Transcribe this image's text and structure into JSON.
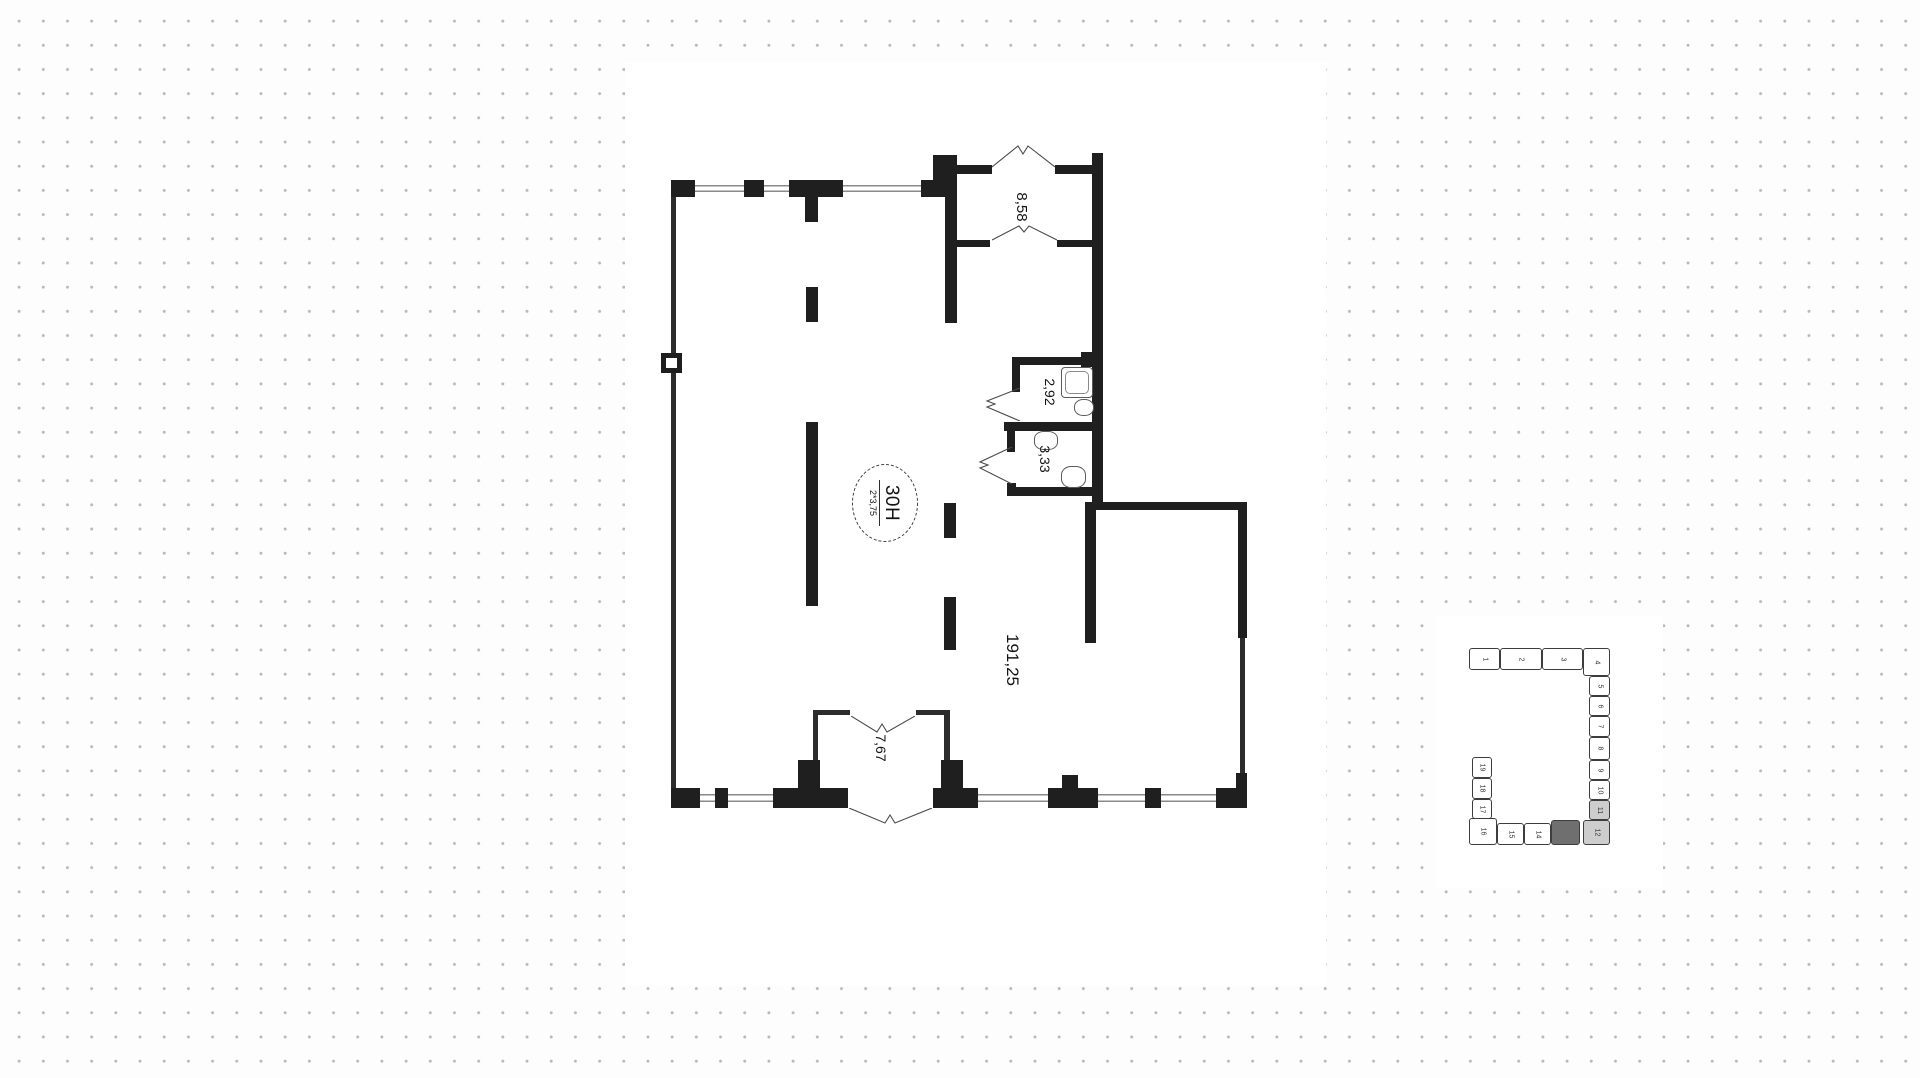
{
  "page": {
    "background_dot_color": "#b9b9b9",
    "wall_color": "#1f1f1f",
    "highlight_current_color": "#6f6f6f",
    "highlight_adjacent_color": "#cdcdcd"
  },
  "floor_plan": {
    "unit_badge": {
      "number": "30H",
      "note": "2*3,75"
    },
    "areas": {
      "top_room": "8,58",
      "wc_small": "2,92",
      "wc_large": "3,33",
      "main_room": "191,25",
      "vestibule": "7,67"
    }
  },
  "minimap": {
    "blocks": [
      {
        "label": "1"
      },
      {
        "label": "2"
      },
      {
        "label": "3"
      },
      {
        "label": "4"
      },
      {
        "label": "5"
      },
      {
        "label": "6"
      },
      {
        "label": "7"
      },
      {
        "label": "8"
      },
      {
        "label": "9"
      },
      {
        "label": "10"
      },
      {
        "label": "11"
      },
      {
        "label": "12"
      },
      {
        "label": ""
      },
      {
        "label": "14"
      },
      {
        "label": "15"
      },
      {
        "label": "16"
      },
      {
        "label": "17"
      },
      {
        "label": "18"
      },
      {
        "label": "19"
      }
    ]
  }
}
